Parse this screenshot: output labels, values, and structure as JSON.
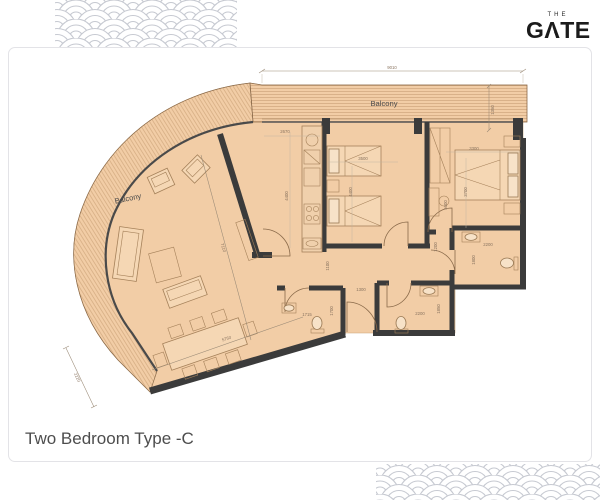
{
  "brand": {
    "the": "THE",
    "name": "GΛTE",
    "mark": "▼"
  },
  "title": "Two Bedroom Type -C",
  "plan": {
    "room_labels": {
      "balcony_top": "Balcony",
      "balcony_left": "Balcony"
    },
    "dims": {
      "overall_width": "9010",
      "balcony_depth": "1350",
      "kitchen_width": "2670",
      "kitchen_depth": "4400",
      "bedroom1_width": "3500",
      "bedroom1_depth": "4400",
      "bedroom2_width": "3300",
      "bedroom2_depth": "3700",
      "bedroom2_length": "5600",
      "hall_right": "1200",
      "hall_height": "1100",
      "hall_width": "1300",
      "bath1_width": "1715",
      "bath1_depth": "1700",
      "bath2_width": "2200",
      "bath2_depth": "1850",
      "bath3_width": "2200",
      "bath3_depth": "1800",
      "living_length": "7110",
      "dining_length": "5750",
      "balcony_end": "2220"
    },
    "colors": {
      "floor": "#f2cda6",
      "wall": "#3b3b3b",
      "furniture_line": "#a5815a",
      "dimension_text": "#8a7460",
      "pattern": "#c6c9d1",
      "title_text": "#4d4d4d",
      "logo": "#1b1b1b"
    }
  }
}
